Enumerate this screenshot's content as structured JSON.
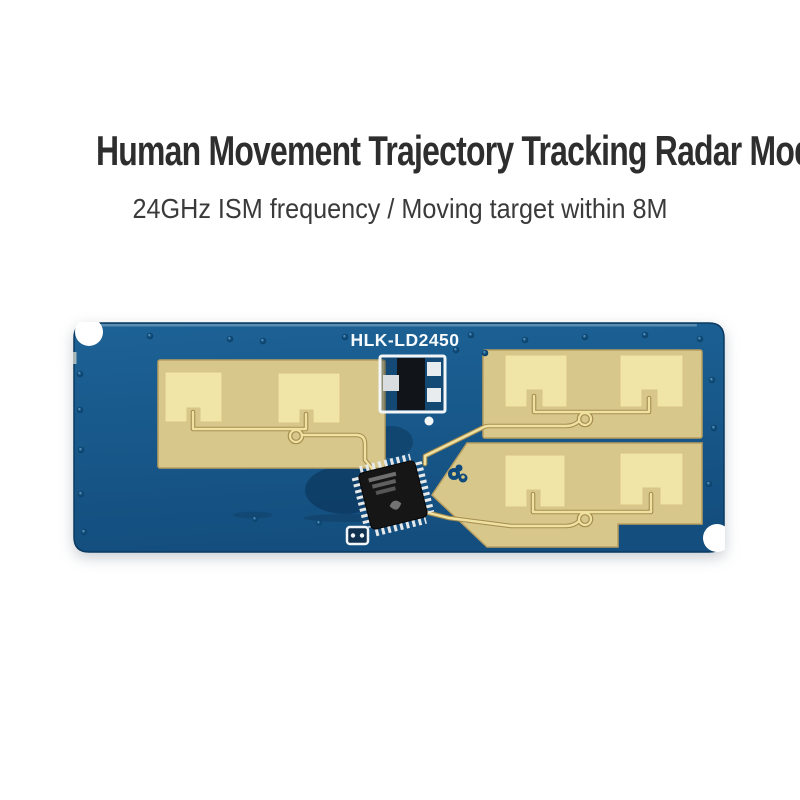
{
  "header": {
    "title": "Human Movement Trajectory Tracking Radar Module",
    "subtitle": "24GHz ISM frequency / Moving target within 8M"
  },
  "board": {
    "silkscreen_label": "HLK-LD2450"
  },
  "colors": {
    "page_background": "#ffffff",
    "title_text": "#2e2e2e",
    "subtitle_text": "#3a3a3a",
    "pcb_blue": "#1d6296",
    "pcb_blue_dark": "#134e7e",
    "pcb_edge": "#0a3a61",
    "copper_gold": "#d7c78b",
    "patch_gold": "#f1e4a7",
    "trace_gold": "#efe1a0",
    "chip_black": "#161616",
    "pin_silver": "#e6e9ea",
    "silkscreen_white": "#f7fafc",
    "via_dark": "#0d456f"
  }
}
